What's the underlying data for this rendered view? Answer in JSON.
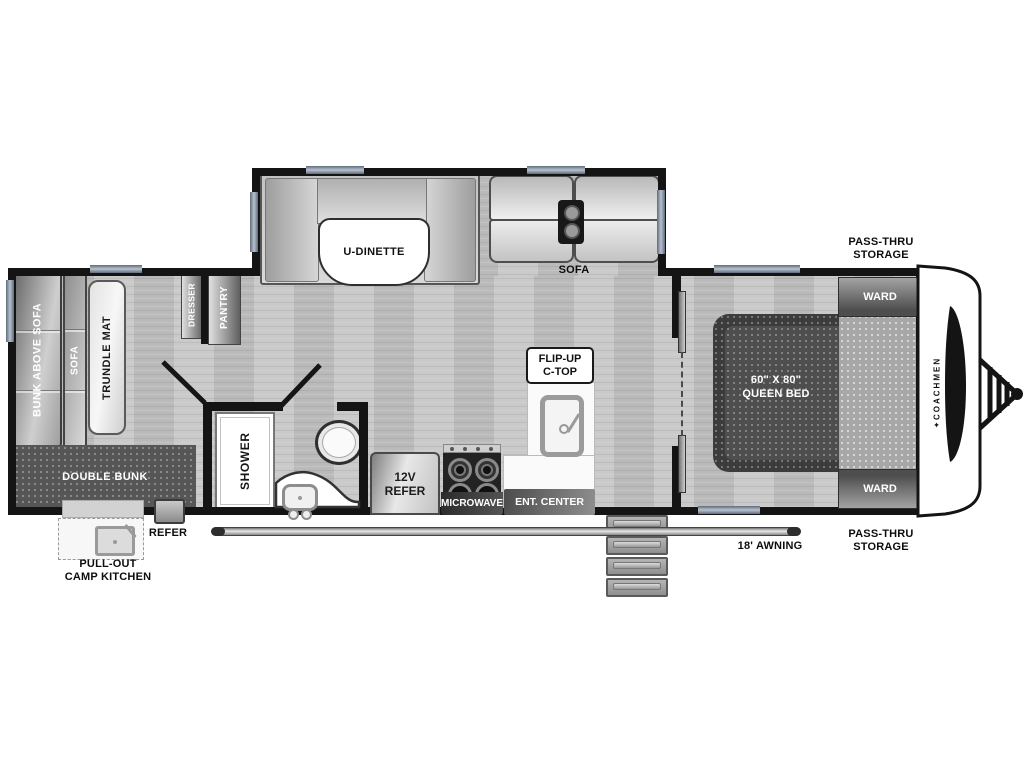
{
  "labels": {
    "bunk_above_sofa": "BUNK ABOVE SOFA",
    "sofa_rear": "SOFA",
    "trundle_mat": "TRUNDLE MAT",
    "double_bunk": "DOUBLE BUNK",
    "refer_exterior": "REFER",
    "camp_kitchen": [
      "PULL-OUT",
      "CAMP KITCHEN"
    ],
    "dresser": "DRESSER",
    "pantry": "PANTRY",
    "shower": "SHOWER",
    "u_dinette": "U-DINETTE",
    "sofa_slideout": "SOFA",
    "flip_up_ctop": [
      "FLIP-UP",
      "C-TOP"
    ],
    "refer_12v": [
      "12V",
      "REFER"
    ],
    "microwave": "MICROWAVE",
    "ent_center": "ENT. CENTER",
    "queen_bed": [
      "60\" X 80\"",
      "QUEEN BED"
    ],
    "ward_top": "WARD",
    "ward_bottom": "WARD",
    "pass_thru_top": [
      "PASS-THRU",
      "STORAGE"
    ],
    "pass_thru_bottom": [
      "PASS-THRU",
      "STORAGE"
    ],
    "awning": "18' AWNING",
    "brand": "COACHMEN"
  },
  "colors": {
    "wall": "#141414",
    "floor": "#c4c4c4",
    "window_accent": "#8a97a8",
    "background": "#ffffff"
  }
}
